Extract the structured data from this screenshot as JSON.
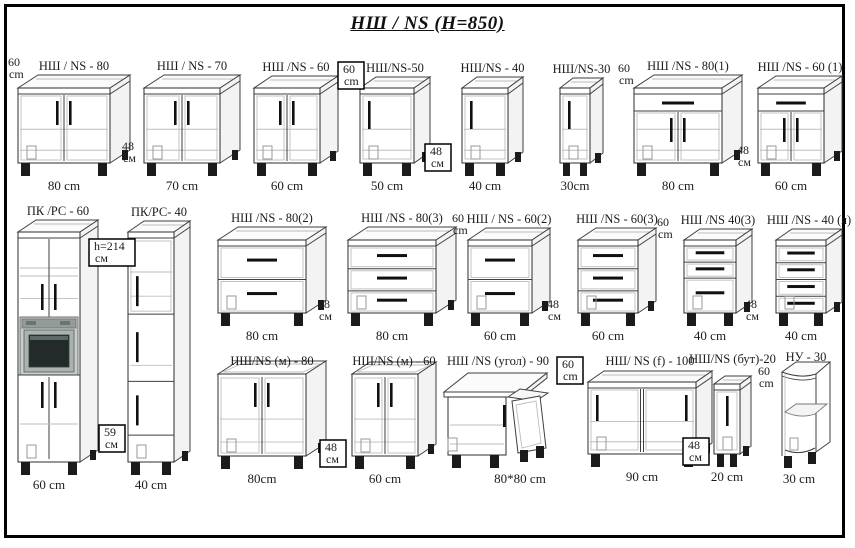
{
  "title": "НШ / NS  (H=850)",
  "canvas": {
    "width": 855,
    "height": 548
  },
  "units_note": "cm",
  "cabinets": [
    {
      "id": "ns-80",
      "label": "НШ / NS - 80",
      "dim": "80 cm",
      "type": "doors2",
      "x": 18,
      "y": 88,
      "w": 92,
      "h": 75,
      "dx": 20,
      "dy": 13
    },
    {
      "id": "ns-70",
      "label": "НШ / NS - 70",
      "dim": "70 cm",
      "type": "doors2",
      "x": 144,
      "y": 88,
      "w": 76,
      "h": 75,
      "dx": 20,
      "dy": 13
    },
    {
      "id": "ns-60",
      "label": "НШ /NS - 60",
      "dim": "60 cm",
      "type": "doors2",
      "x": 254,
      "y": 88,
      "w": 66,
      "h": 75,
      "dx": 18,
      "dy": 12
    },
    {
      "id": "ns-50",
      "label": "НШ/NS-50",
      "dim": "50 cm",
      "type": "doors1",
      "x": 360,
      "y": 88,
      "w": 54,
      "h": 75,
      "dx": 16,
      "dy": 11
    },
    {
      "id": "ns-40",
      "label": "НШ/NS - 40",
      "dim": "40 cm",
      "type": "doors1",
      "x": 462,
      "y": 88,
      "w": 46,
      "h": 75,
      "dx": 15,
      "dy": 11
    },
    {
      "id": "ns-30",
      "label": "НШ/NS-30",
      "dim": "30cm",
      "type": "doors1",
      "x": 560,
      "y": 88,
      "w": 30,
      "h": 75,
      "dx": 13,
      "dy": 10
    },
    {
      "id": "ns-80-1",
      "label": "НШ /NS - 80(1)",
      "dim": "80 cm",
      "type": "drawer_doors2",
      "x": 634,
      "y": 88,
      "w": 88,
      "h": 75,
      "dx": 20,
      "dy": 13
    },
    {
      "id": "ns-60-1",
      "label": "НШ /NS - 60 (1)",
      "dim": "60 cm",
      "type": "drawer_doors2",
      "x": 758,
      "y": 88,
      "w": 66,
      "h": 75,
      "dx": 18,
      "dy": 12
    },
    {
      "id": "pk-pc-60",
      "label": "ПК /РС - 60",
      "dim": "60 cm",
      "type": "tall_oven",
      "x": 18,
      "y": 232,
      "w": 62,
      "h": 230,
      "dx": 18,
      "dy": 12
    },
    {
      "id": "pk-pc-40",
      "label": "ПК/РС- 40",
      "dim": "40 cm",
      "type": "tall3",
      "x": 128,
      "y": 232,
      "w": 46,
      "h": 230,
      "dx": 16,
      "dy": 11
    },
    {
      "id": "ns-80-2",
      "label": "НШ /NS - 80(2)",
      "dim": "80 cm",
      "type": "drawers2",
      "x": 218,
      "y": 240,
      "w": 88,
      "h": 73,
      "dx": 20,
      "dy": 13
    },
    {
      "id": "ns-80-3",
      "label": "НШ /NS - 80(3)",
      "dim": "80 cm",
      "type": "drawers3",
      "x": 348,
      "y": 240,
      "w": 88,
      "h": 73,
      "dx": 20,
      "dy": 13
    },
    {
      "id": "ns-60-2",
      "label": "НШ / NS - 60(2)",
      "dim": "60 cm",
      "type": "drawers2",
      "x": 468,
      "y": 240,
      "w": 64,
      "h": 73,
      "dx": 18,
      "dy": 12
    },
    {
      "id": "ns-60-3",
      "label": "НШ /NS - 60(3)",
      "dim": "60 cm",
      "type": "drawers3",
      "x": 578,
      "y": 240,
      "w": 60,
      "h": 73,
      "dx": 18,
      "dy": 12
    },
    {
      "id": "ns-40-3",
      "label": "НШ /NS 40(3)",
      "dim": "40 cm",
      "type": "drawers3b",
      "x": 684,
      "y": 240,
      "w": 52,
      "h": 73,
      "dx": 16,
      "dy": 11
    },
    {
      "id": "ns-40-ya",
      "label": "НШ /NS - 40 (я)",
      "dim": "40 cm",
      "type": "drawers4",
      "x": 776,
      "y": 240,
      "w": 50,
      "h": 73,
      "dx": 16,
      "dy": 11
    },
    {
      "id": "ns-m-80",
      "label": "НШ/NS (м) - 80",
      "dim": "80cm",
      "type": "sink2",
      "x": 218,
      "y": 374,
      "w": 88,
      "h": 82,
      "dx": 20,
      "dy": 13,
      "ly": 365
    },
    {
      "id": "ns-m-60",
      "label": "НШ/NS (м) - 60",
      "dim": "60 cm",
      "type": "sink2",
      "x": 352,
      "y": 374,
      "w": 66,
      "h": 82,
      "dx": 18,
      "dy": 12,
      "ly": 365
    },
    {
      "id": "ns-ugol-90",
      "label": "НШ /NS (угол) - 90",
      "dim": "80*80 cm",
      "type": "corner",
      "x": 443,
      "y": 372,
      "w": 102,
      "h": 84,
      "dx": 8,
      "dy": 8,
      "ly": 365,
      "dim_x": 520
    },
    {
      "id": "ns-f-100",
      "label": "НШ/ NS (f) - 100",
      "dim": "90 cm",
      "type": "doors2w",
      "x": 588,
      "y": 382,
      "w": 108,
      "h": 72,
      "dx": 16,
      "dy": 11,
      "ly": 365
    },
    {
      "id": "ns-but-20",
      "label": "НШ/NS (бут)-20",
      "dim": "20 cm",
      "type": "bottle",
      "x": 714,
      "y": 384,
      "w": 26,
      "h": 70,
      "dx": 11,
      "dy": 8,
      "ly": 363
    },
    {
      "id": "nu-30",
      "label": "НУ - 30",
      "dim": "30 cm",
      "type": "shelf_open",
      "x": 782,
      "y": 372,
      "w": 34,
      "h": 84,
      "dx": 14,
      "dy": 10,
      "ly": 361
    }
  ],
  "side_labels": [
    {
      "lines": [
        "60",
        "cm"
      ],
      "x": 8,
      "y": 56,
      "boxed": false
    },
    {
      "lines": [
        "48",
        "см"
      ],
      "x": 122,
      "y": 140,
      "boxed": false
    },
    {
      "lines": [
        "60",
        "cm"
      ],
      "x": 343,
      "y": 63,
      "boxed": true,
      "bw": 26
    },
    {
      "lines": [
        "48",
        "см"
      ],
      "x": 430,
      "y": 145,
      "boxed": true,
      "bw": 26
    },
    {
      "lines": [
        "60",
        "cm"
      ],
      "x": 618,
      "y": 62,
      "boxed": false
    },
    {
      "lines": [
        "48",
        "см"
      ],
      "x": 737,
      "y": 144,
      "boxed": false
    },
    {
      "lines": [
        "h=214",
        "см"
      ],
      "x": 94,
      "y": 240,
      "boxed": true,
      "bw": 46
    },
    {
      "lines": [
        "59",
        "см"
      ],
      "x": 104,
      "y": 426,
      "boxed": true,
      "bw": 26
    },
    {
      "lines": [
        "48",
        "см"
      ],
      "x": 318,
      "y": 298,
      "boxed": false
    },
    {
      "lines": [
        "60",
        "cm"
      ],
      "x": 452,
      "y": 212,
      "boxed": false
    },
    {
      "lines": [
        "48",
        "см"
      ],
      "x": 547,
      "y": 298,
      "boxed": false
    },
    {
      "lines": [
        "60",
        "cm"
      ],
      "x": 657,
      "y": 216,
      "boxed": false
    },
    {
      "lines": [
        "48",
        "см"
      ],
      "x": 745,
      "y": 298,
      "boxed": false
    },
    {
      "lines": [
        "48",
        "см"
      ],
      "x": 325,
      "y": 441,
      "boxed": true,
      "bw": 26
    },
    {
      "lines": [
        "60",
        "cm"
      ],
      "x": 562,
      "y": 358,
      "boxed": true,
      "bw": 26
    },
    {
      "lines": [
        "48",
        "см"
      ],
      "x": 688,
      "y": 439,
      "boxed": true,
      "bw": 26
    },
    {
      "lines": [
        "60",
        "cm"
      ],
      "x": 758,
      "y": 365,
      "boxed": false
    }
  ],
  "colors": {
    "line": "#3f3f3f",
    "light_line": "#bdbdbd",
    "top_fill": "#fbfbfb",
    "side_fill": "#f3f3f3",
    "handle": "#101010",
    "oven_frame": "#c7cdcb",
    "oven_strip": "#929c99",
    "oven_bevel": "#a9b3b0",
    "oven_screen": "#222b2a"
  }
}
